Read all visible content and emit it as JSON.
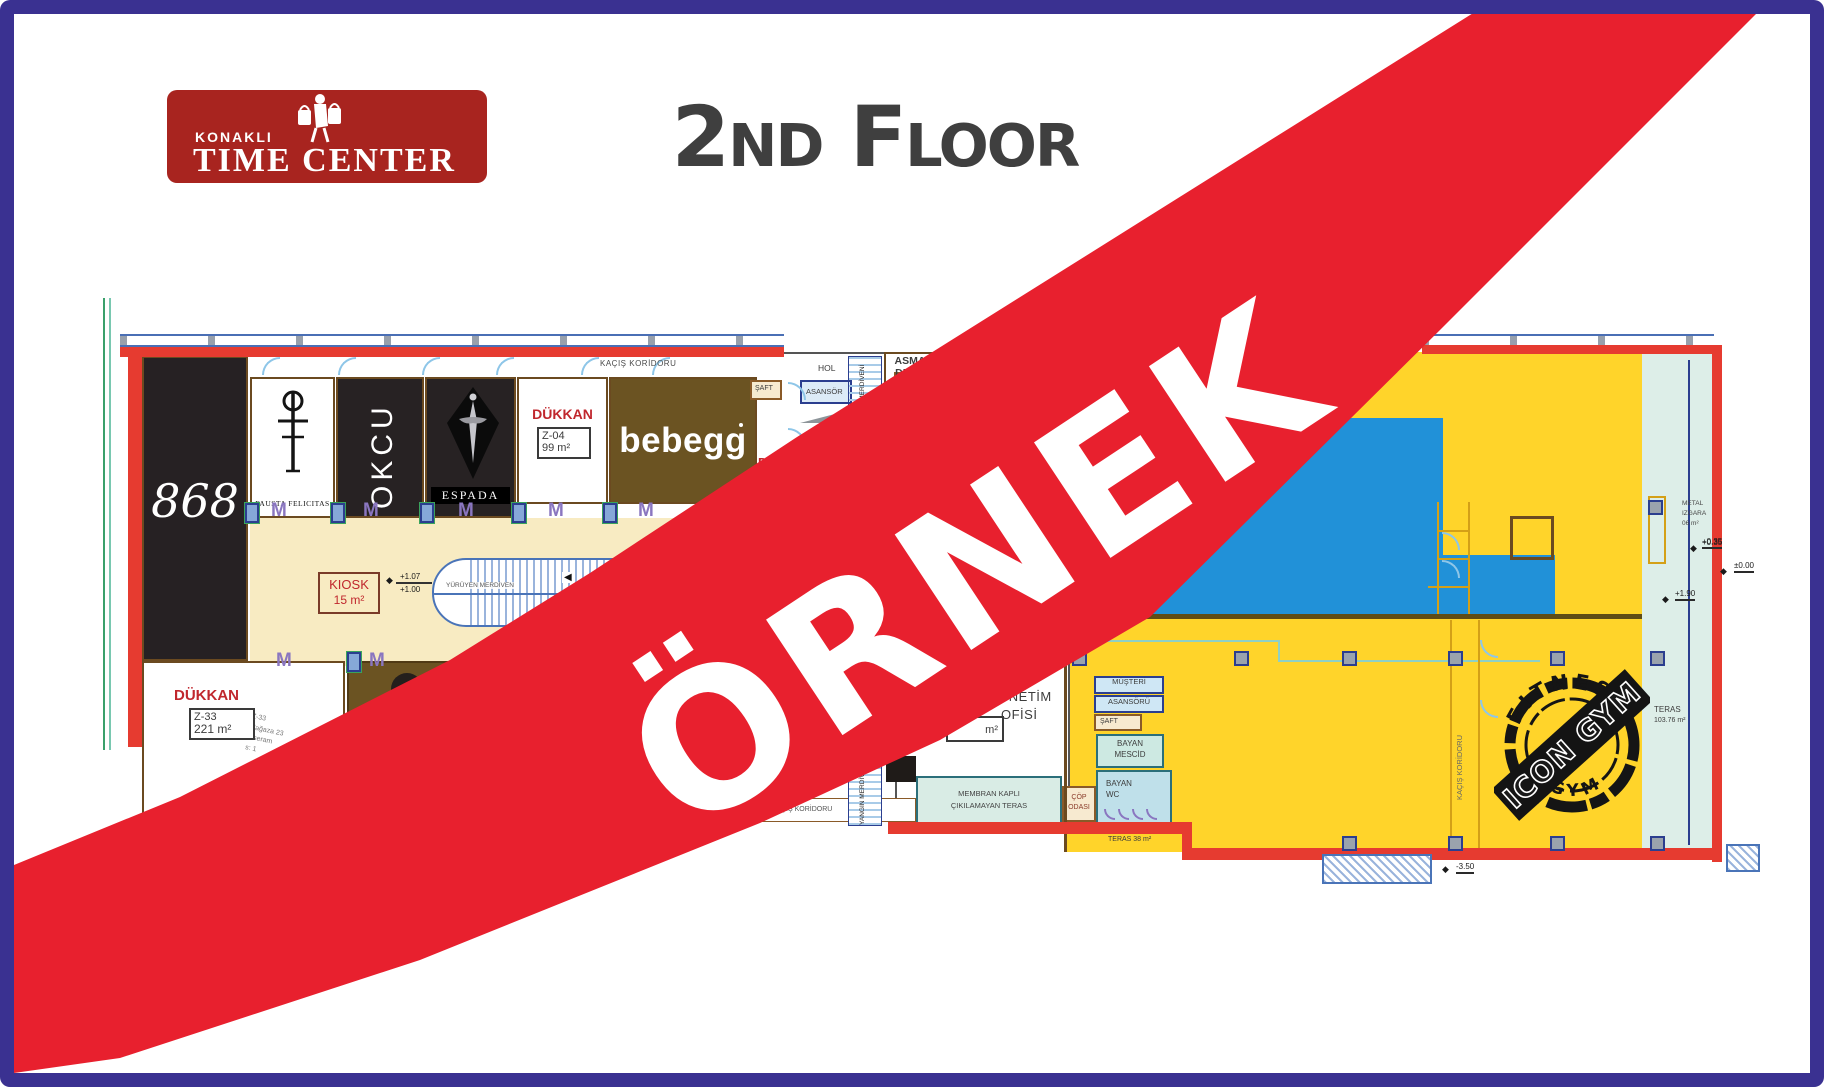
{
  "colors": {
    "frame": "#3a3191",
    "banner_red": "#e8202e",
    "logo_red": "#a8241f",
    "plan_red": "#e63b30",
    "gym_yellow": "#ffd42a",
    "pool_blue": "#2191d8",
    "concourse_cream": "#f8ebc2",
    "bebegg_brown": "#6b5322"
  },
  "logo": {
    "kicker": "KONAKLI",
    "name": "TIME CENTER"
  },
  "title": "2nd Floor",
  "watermark": "ÖRNEK",
  "plan": {
    "corridor_top": "KAÇIŞ KORİDORU",
    "corridor_bottom": "KAÇIŞ KORİDORU",
    "corridor_right": "KAÇIŞ KORİDORU",
    "shops": {
      "s868": "868",
      "fausta": "FAUSTA FELICITAS",
      "okcu": "OKCU",
      "espada": "ESPADA",
      "bebegg": "bebegg",
      "z04": {
        "label": "DÜKKAN",
        "code": "Z-04",
        "area": "99 m²"
      },
      "z33": {
        "label": "DÜKKAN",
        "code": "Z-33",
        "area": "221 m²",
        "notes": [
          "Z-33",
          "Mağaza 23",
          "d:seram",
          "s: 1"
        ]
      },
      "unlabeled": "DÜKKAN"
    },
    "kiosk": {
      "name": "KIOSK",
      "area": "15 m²"
    },
    "escalator": "YÜRÜYEN MERDİVEN",
    "rooms": {
      "hol": "HOL",
      "asansor": "ASANSÖR",
      "saft": "ŞAFT",
      "yangin": "YANGIN MERDİVENİ",
      "asma": [
        "ASMA",
        "DEPO"
      ],
      "yonetim": [
        "YÖNETİM",
        "OFİSİ"
      ],
      "yonetim_area": "m²",
      "musteri": [
        "MÜŞTERİ",
        "ASANSÖRÜ"
      ],
      "mescid": [
        "BAYAN",
        "MESCİD"
      ],
      "wc": [
        "BAYAN",
        "WC"
      ],
      "cop": [
        "ÇÖP",
        "ODASI"
      ],
      "membran": [
        "MEMBRAN KAPLI",
        "ÇIKILAMAYAN TERAS"
      ]
    },
    "teras_right": {
      "name": "TERAS",
      "area": "103.76 m²"
    },
    "teras_bottom": "TERAS 38 m²",
    "metal": [
      "METAL",
      "IZGARA",
      "06 m²"
    ],
    "elevations": {
      "p107": "+1.07",
      "p100": "+1.00",
      "p035": "+0.35",
      "zero": "±0.00",
      "p190": "+1.90",
      "m350": "-3.50"
    },
    "stamp": {
      "arc_top": "FITNESS",
      "arc_bottom": "GYM",
      "bar": "ICON GYM"
    },
    "symbols": {
      "door": "M",
      "arrow": "◀",
      "diamond": "◆"
    }
  }
}
